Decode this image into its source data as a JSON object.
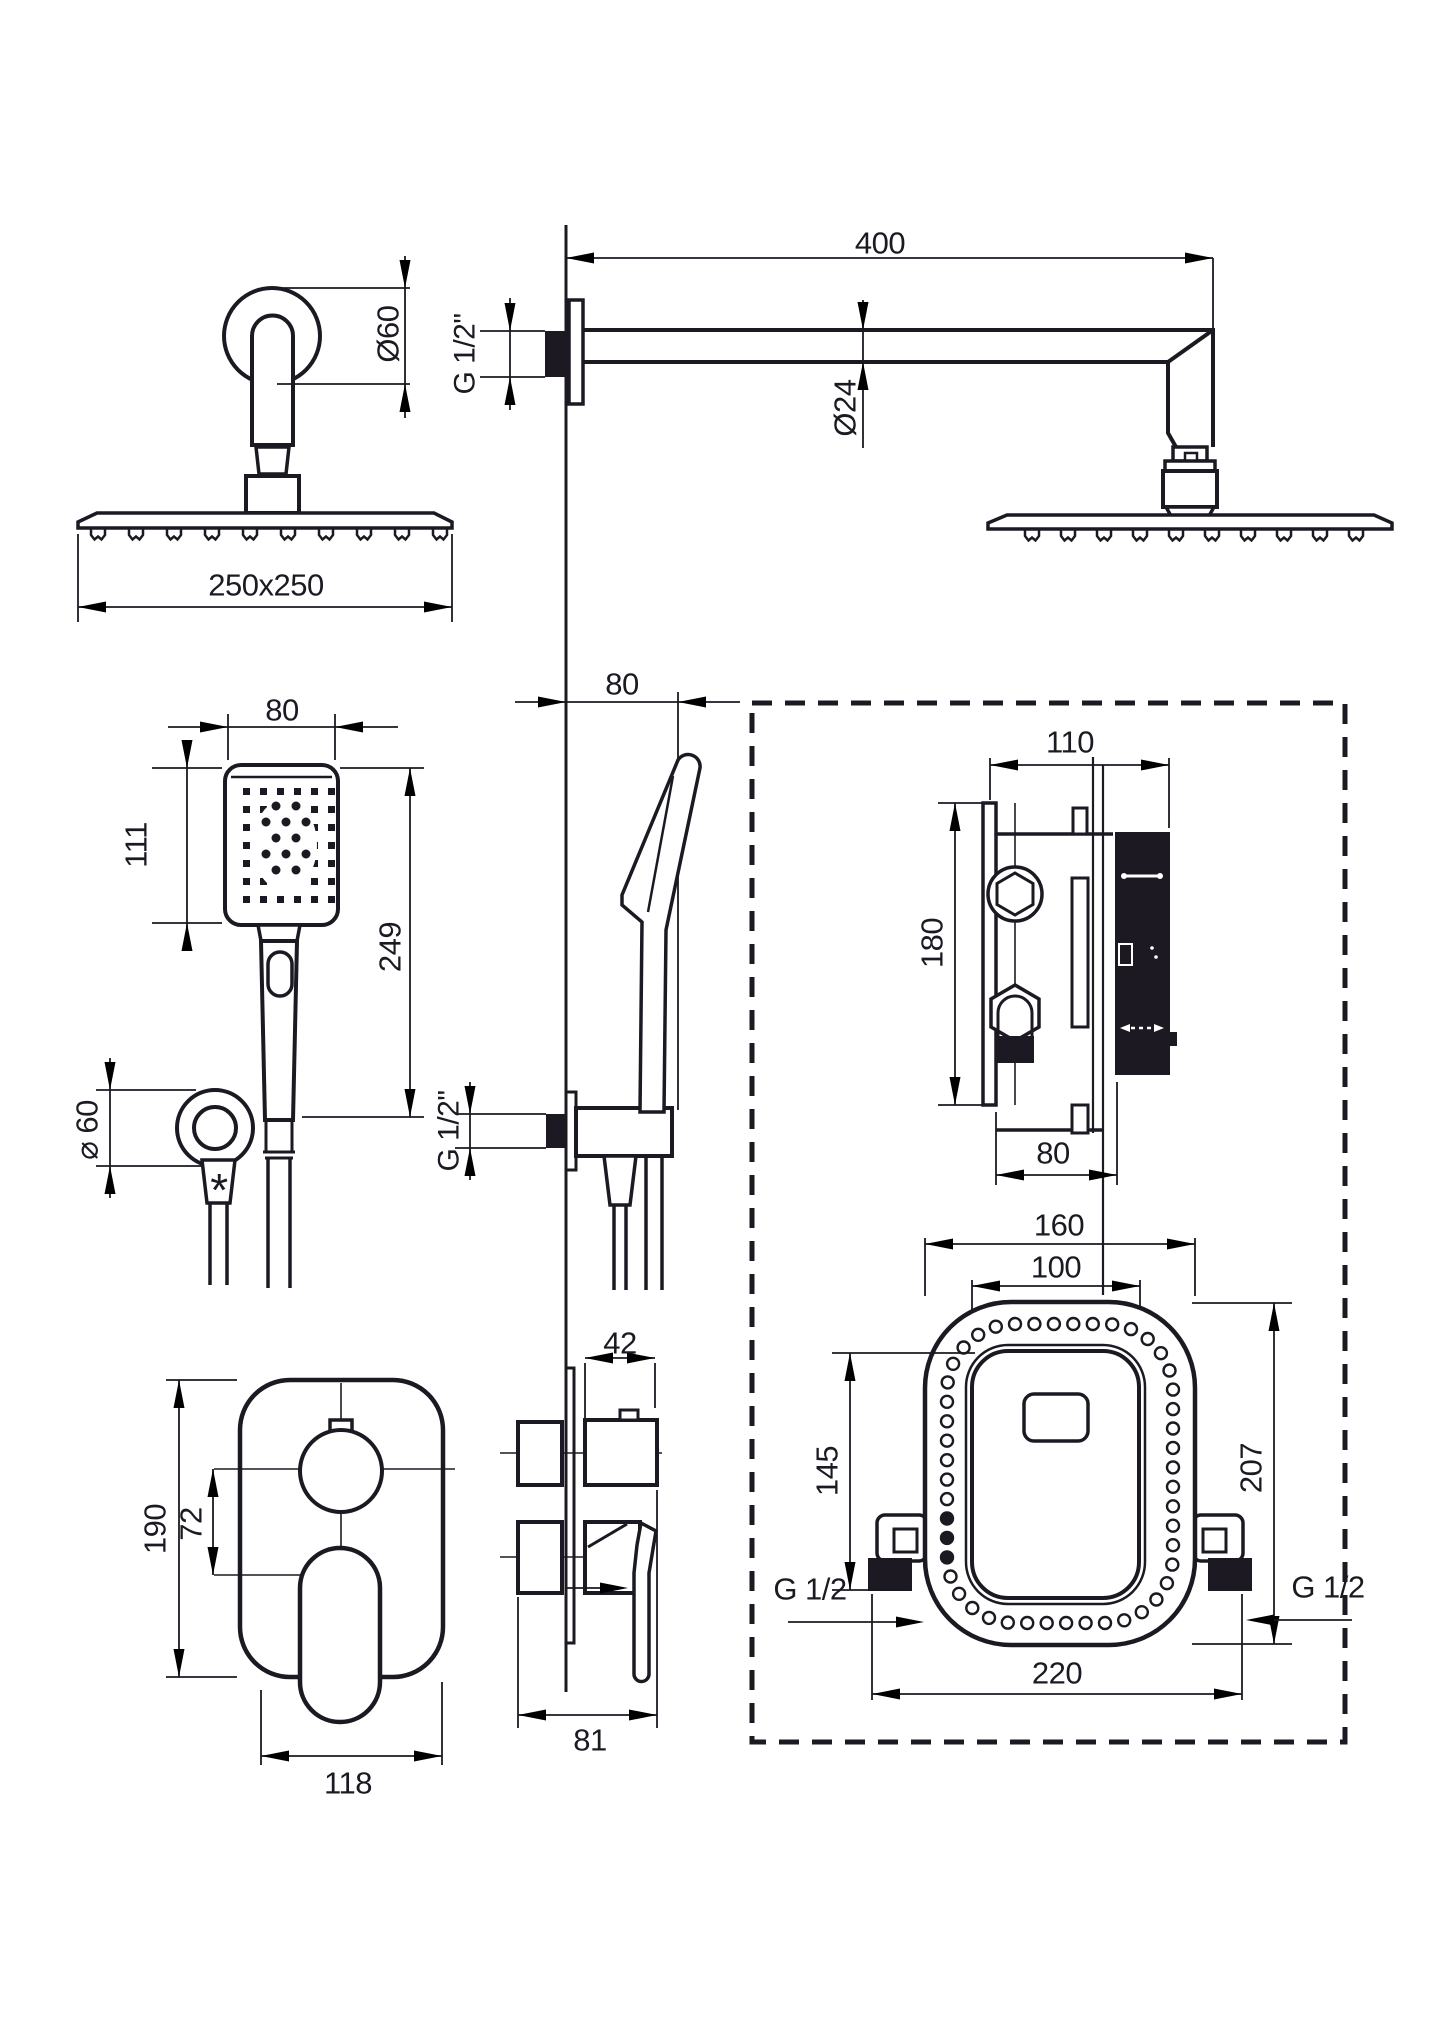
{
  "sheet": {
    "background": "#ffffff",
    "ink": "#1c1923"
  },
  "views": {
    "elbow": {
      "rosette_diameter": "Ø60"
    },
    "head": {
      "size": "250x250"
    },
    "arm": {
      "length": "400",
      "thread": "G 1/2\"",
      "pipe_diameter": "Ø24"
    },
    "handshower": {
      "width": "80",
      "face_height": "111",
      "length": "249"
    },
    "handshower_side": {
      "wall_offset": "80",
      "holder_thread": "G 1/2\""
    },
    "holder": {
      "rosette_diameter": "⌀ 60",
      "footnote": "*"
    },
    "valve_side": {
      "depth": "110",
      "height": "180",
      "body_depth": "80"
    },
    "valve_front": {
      "outer_width": "160",
      "inner_width": "100",
      "inner_height": "145",
      "outer_height": "207",
      "connector_span": "220",
      "thread_left": "G 1/2",
      "thread_right": "G 1/2"
    },
    "mixer_front": {
      "height": "190",
      "centers": "72",
      "width": "118"
    },
    "mixer_side": {
      "knob_depth": "42",
      "depth": "81"
    }
  }
}
